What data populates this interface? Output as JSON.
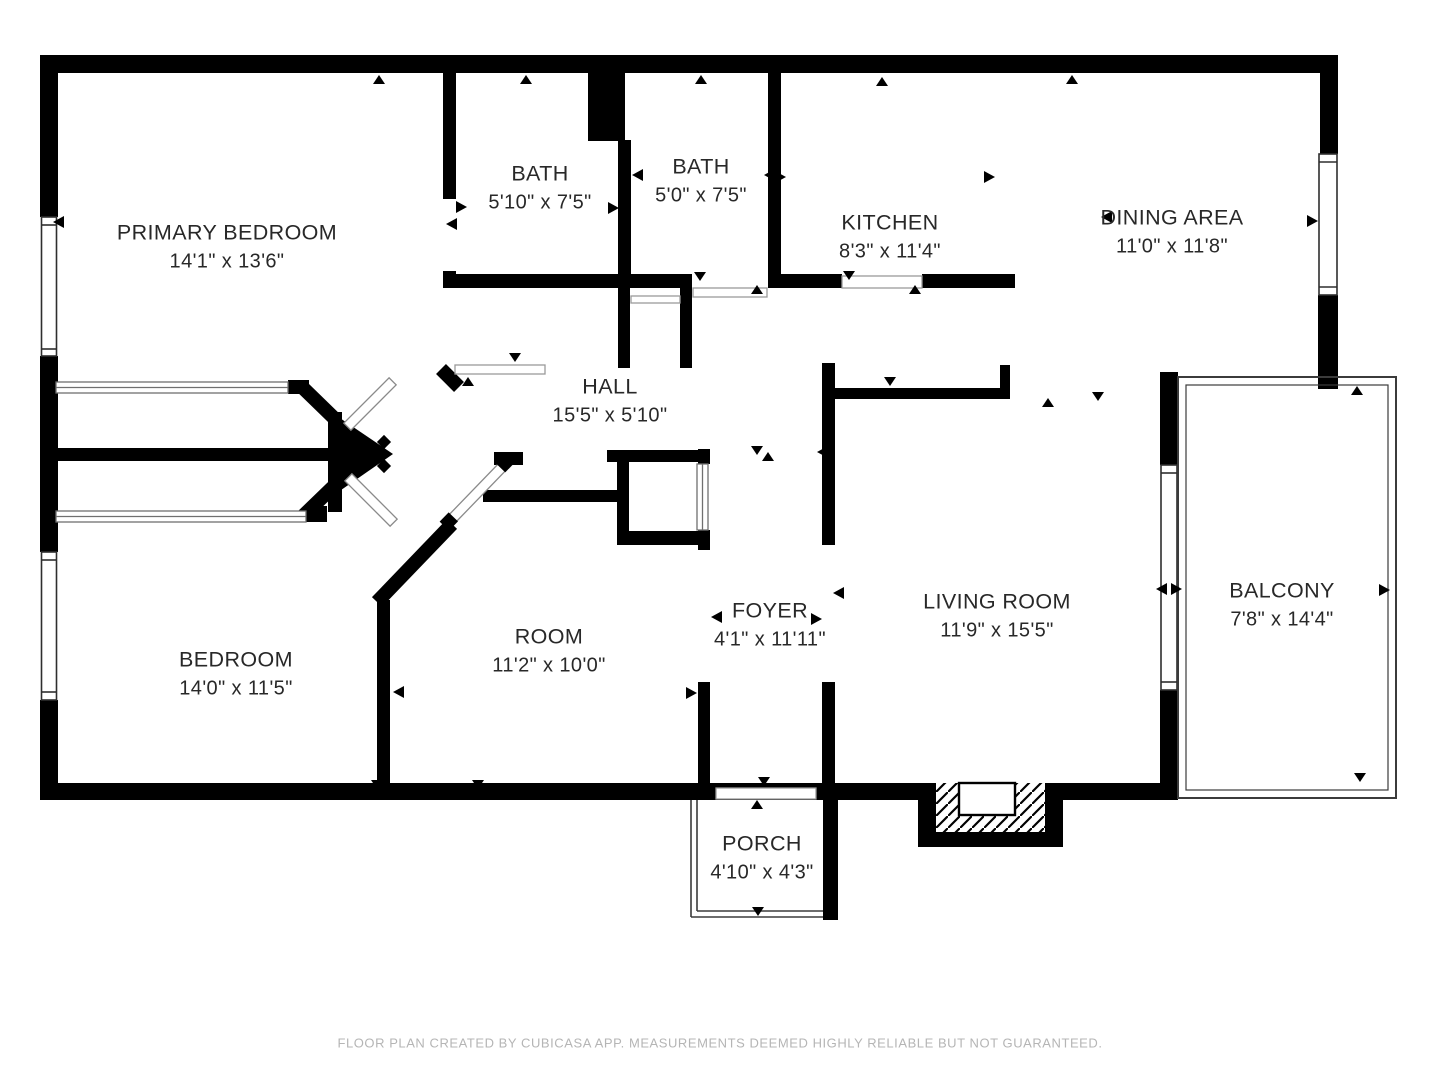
{
  "plan": {
    "rooms": [
      {
        "name": "PRIMARY BEDROOM",
        "dimensions": "14'1\" x 13'6\""
      },
      {
        "name": "BATH",
        "dimensions": "5'10\" x 7'5\""
      },
      {
        "name": "BATH",
        "dimensions": "5'0\" x 7'5\""
      },
      {
        "name": "KITCHEN",
        "dimensions": "8'3\" x 11'4\""
      },
      {
        "name": "DINING AREA",
        "dimensions": "11'0\" x 11'8\""
      },
      {
        "name": "HALL",
        "dimensions": "15'5\" x 5'10\""
      },
      {
        "name": "BEDROOM",
        "dimensions": "14'0\" x 11'5\""
      },
      {
        "name": "ROOM",
        "dimensions": "11'2\" x 10'0\""
      },
      {
        "name": "FOYER",
        "dimensions": "4'1\" x 11'11\""
      },
      {
        "name": "LIVING ROOM",
        "dimensions": "11'9\" x 15'5\""
      },
      {
        "name": "BALCONY",
        "dimensions": "7'8\" x 14'4\""
      },
      {
        "name": "PORCH",
        "dimensions": "4'10\" x 4'3\""
      }
    ],
    "footer": "FLOOR PLAN CREATED BY CUBICASA APP. MEASUREMENTS DEEMED HIGHLY RELIABLE BUT NOT GUARANTEED.",
    "colors": {
      "wall": "#000000",
      "label": "#282828",
      "footer": "#b5b5b5",
      "background": "#ffffff"
    }
  }
}
